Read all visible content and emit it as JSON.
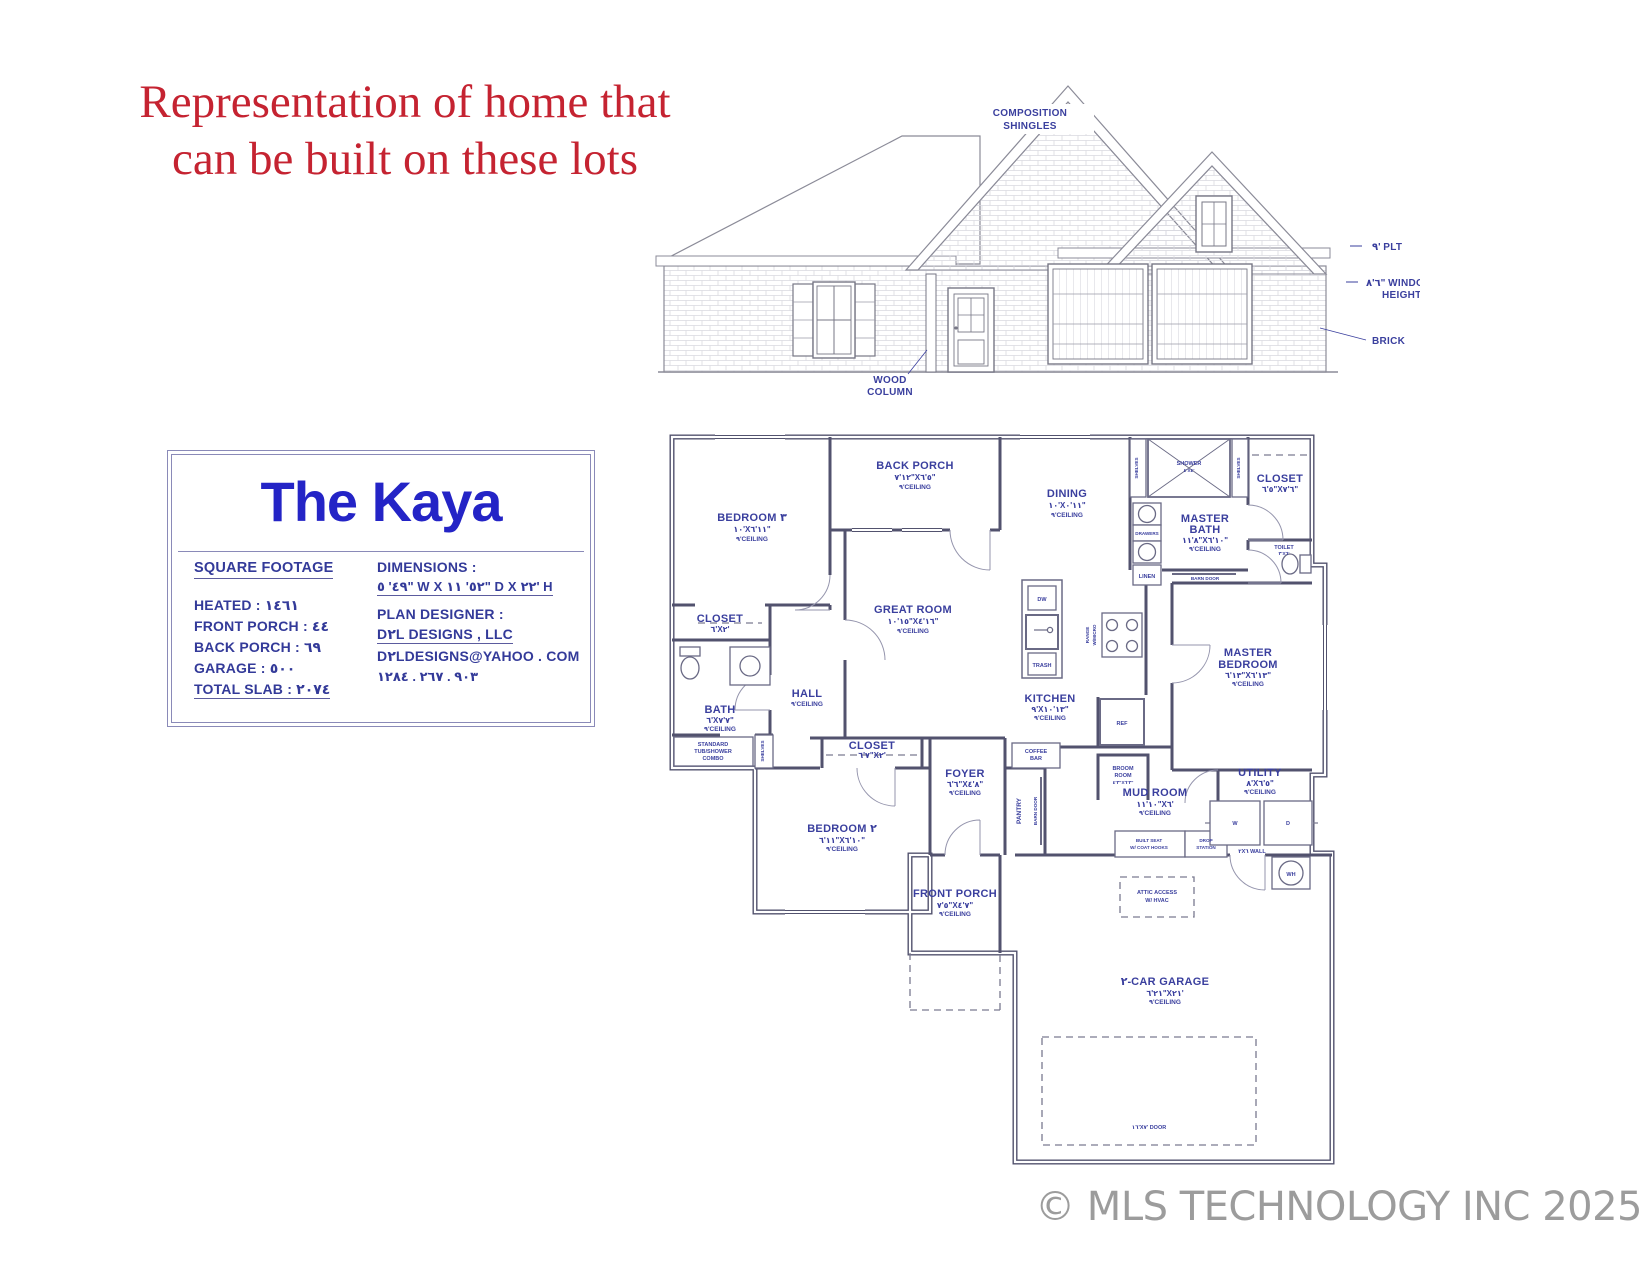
{
  "header": {
    "line1": "Representation of home that",
    "line2": "can be built on these lots"
  },
  "watermark": "© MLS TECHNOLOGY INC 2025",
  "colors": {
    "headline_red": "#c52331",
    "blueprint_blue": "#3a3f9e",
    "title_blue": "#2424c6",
    "wall_line": "#52526e",
    "watermark_gray": "#9c9c9c"
  },
  "title_block": {
    "title": "The Kaya",
    "square_footage_heading": "SQUARE FOOTAGE",
    "heated": "HEATED : ١٤٦١",
    "front_porch": "FRONT PORCH : ٤٤",
    "back_porch": "BACK PORCH : ٦٩",
    "garage": "GARAGE : ٥٠٠",
    "total_slab": "TOTAL SLAB : ٢٠٧٤",
    "dimensions_heading": "DIMENSIONS :",
    "dimensions_value": "٤٩' ٥\" W X ٥٢' ١١\" D X ٢٢' H",
    "designer_heading": "PLAN DESIGNER :",
    "designer_name": "D٢L DESIGNS , LLC",
    "designer_email": "D٢LDESIGNS@YAHOO . COM",
    "designer_phone": "٩٠٣ . ٢٦٧ . ١٢٨٤"
  },
  "elevation": {
    "shingles_l1": "COMPOSITION",
    "shingles_l2": "SHINGLES",
    "wood_l1": "WOOD",
    "wood_l2": "COLUMN",
    "plt": "٩' PLT",
    "window_height_l1": "٦'٨\" WINDOW",
    "window_height_l2": "HEIGHT",
    "brick": "BRICK"
  },
  "plan": {
    "bedroom3": {
      "name": "BEDROOM ٣",
      "dims": "١٠'X١١'٦\"",
      "ceiling": "٩'CEILING"
    },
    "back_porch": {
      "name": "BACK PORCH",
      "dims": "١٢'٧\"X٥'٦\"",
      "ceiling": "٩'CEILING"
    },
    "dining": {
      "name": "DINING",
      "dims": "١٠'X١١'٠\"",
      "ceiling": "٩'CEILING"
    },
    "great_room": {
      "name": "GREAT ROOM",
      "dims": "١٥'١٠\"X١٦'٤\"",
      "ceiling": "٩'CEILING"
    },
    "master_bath": {
      "name1": "MASTER",
      "name2": "BATH",
      "dims": "٨'١١\"X١٠'٦\"",
      "ceiling": "٩'CEILING"
    },
    "master_closet": {
      "name": "CLOSET",
      "dims": "٥'٦\"X٦'٧\""
    },
    "toilet": {
      "name": "TOILET",
      "dims": "٣'X٦'"
    },
    "shower": {
      "name": "SHOWER",
      "dims": "٤'X٤'"
    },
    "master_bedroom": {
      "name1": "MASTER",
      "name2": "BEDROOM",
      "dims": "١٣'٦\"X١٣'٦\"",
      "ceiling": "٩'CEILING"
    },
    "kitchen": {
      "name": "KITCHEN",
      "dims": "٩'X١٣'١٠\"",
      "ceiling": "٩'CEILING"
    },
    "bath": {
      "name": "BATH",
      "dims": "٦'X٧'٧\"",
      "ceiling": "٩'CEILING"
    },
    "hall": {
      "name": "HALL",
      "ceiling": "٩'CEILING"
    },
    "closet_bed3": {
      "name": "CLOSET",
      "dims": "٦'X٢'"
    },
    "closet_bed2": {
      "name": "CLOSET",
      "dims": "٧'٦\"X٢'"
    },
    "bedroom2": {
      "name": "BEDROOM ٢",
      "dims": "١١'٦\"X١٠'٦\"",
      "ceiling": "٩'CEILING"
    },
    "foyer": {
      "name": "FOYER",
      "dims": "٦'٦\"X٨'٤\"",
      "ceiling": "٩'CEILING"
    },
    "front_porch": {
      "name": "FRONT PORCH",
      "dims": "٥'٧\"X٧'٤\"",
      "ceiling": "٩'CEILING"
    },
    "mud_room": {
      "name": "MUD ROOM",
      "dims": "١٠'١١\"X٦'",
      "ceiling": "٩'CEILING"
    },
    "utility": {
      "name": "UTILITY",
      "dims": "٨'X٥'٦\"",
      "ceiling": "٩'CEILING"
    },
    "broom": {
      "name1": "BROOM",
      "name2": "ROOM",
      "dims": "٢'٤\"X٢'٦\""
    },
    "garage": {
      "name": "٢-CAR GARAGE",
      "dims": "٢١'٦\"X٢١'",
      "ceiling": "٩'CEILING"
    },
    "labels": {
      "tub1": "STANDARD",
      "tub2": "TUB/SHOWER",
      "tub3": "COMBO",
      "shelves": "SHELVES",
      "drawers": "DRAWERS",
      "linen": "LINEN",
      "barn_door": "BARN DOOR",
      "dw": "DW",
      "trash": "TRASH",
      "ref": "REF",
      "range1": "RANGE",
      "range2": "W/MICRO",
      "coffee1": "COFFEE",
      "coffee2": "BAR",
      "pantry": "PANTRY",
      "washer": "W",
      "dryer": "D",
      "water_heater": "WH",
      "wall_2x6": "٢X٦ WALL",
      "seat1": "BUILT SEAT",
      "seat2": "W/ COAT HOOKS",
      "drop1": "DROP",
      "drop2": "STATION",
      "attic1": "ATTIC ACCESS",
      "attic2": "W/ HVAC",
      "garage_door": "١٦'X٧' DOOR"
    }
  }
}
